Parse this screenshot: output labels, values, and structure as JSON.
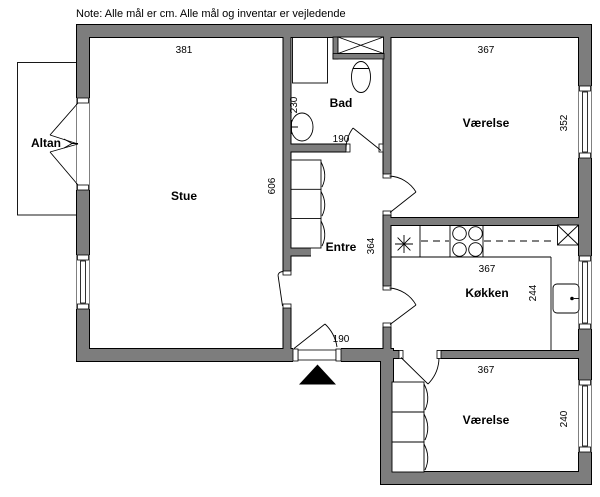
{
  "note": "Note: Alle mål er cm. Alle mål og inventar er vejledende",
  "colors": {
    "wall": "#7d7d7d",
    "ink": "#000000",
    "bg": "#ffffff"
  },
  "rooms": {
    "altan": {
      "label": "Altan"
    },
    "stue": {
      "label": "Stue",
      "width": "381",
      "depth": "606"
    },
    "bad": {
      "label": "Bad",
      "depth": "230",
      "door": "190"
    },
    "vaerelse_top": {
      "label": "Værelse",
      "width": "367",
      "depth": "352"
    },
    "entre": {
      "label": "Entre",
      "depth": "364",
      "entrance": "190"
    },
    "koekken": {
      "label": "Køkken",
      "width": "367",
      "depth": "244"
    },
    "vaerelse_bottom": {
      "label": "Værelse",
      "width": "367",
      "depth": "240"
    }
  }
}
